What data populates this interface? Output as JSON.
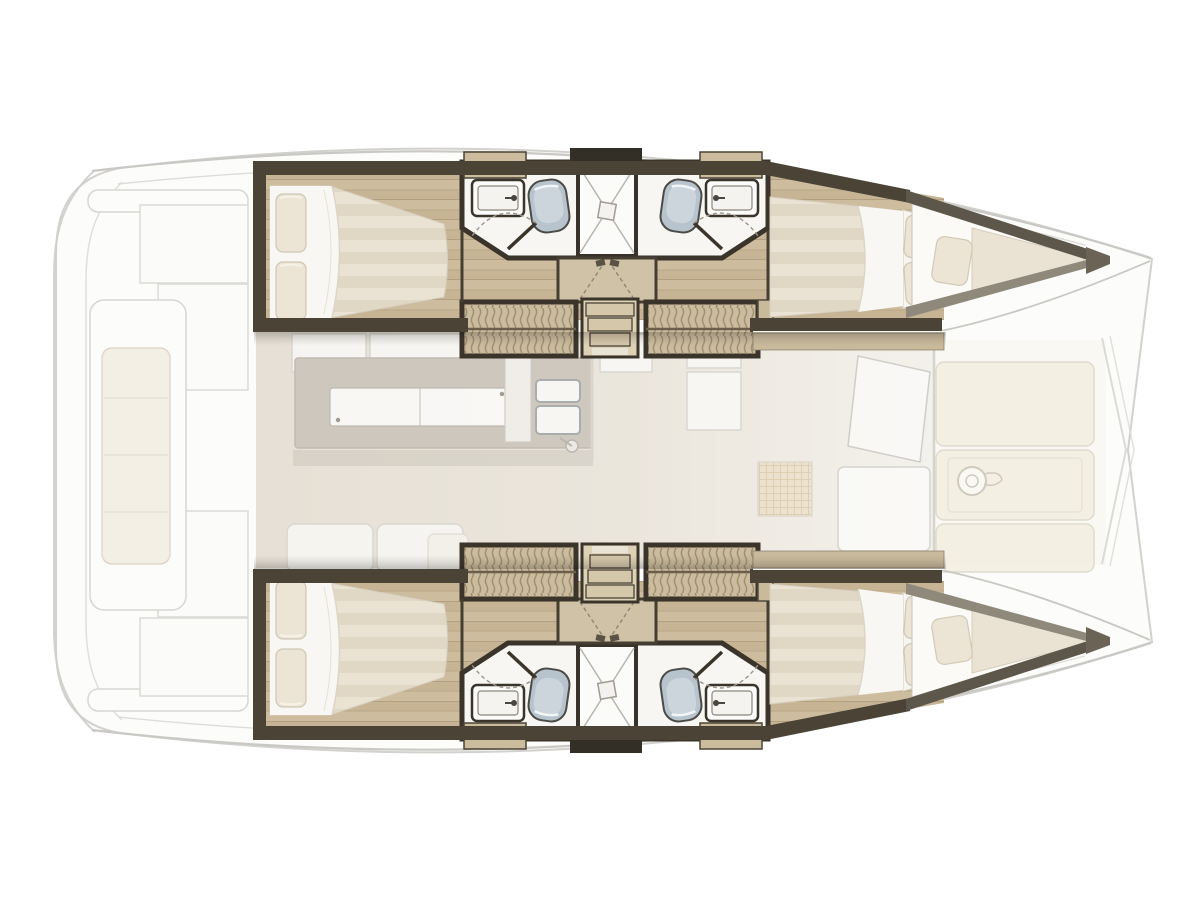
{
  "diagram": {
    "type": "floor-plan",
    "subject": "Catamaran yacht interior layout, top view, bow facing right",
    "style": "architectural rendering, no text labels",
    "symmetry": "port and starboard hulls mirrored about horizontal axis",
    "counts": {
      "double_cabins": 4,
      "bow_berths": 2,
      "toilets": 4,
      "washbasins": 4,
      "showers": 2,
      "companionway_stairs": 2
    },
    "zones": {
      "aft_deck": {
        "label": "aft cockpit and swim platforms",
        "items": [
          "swim-platform-curve",
          "transom-step-bar",
          "cockpit-locker",
          "cockpit-locker",
          "helm-bench",
          "bench-cushion"
        ]
      },
      "saloon": {
        "label": "bridge-deck saloon and galley",
        "items": [
          "overhead-cabinet",
          "overhead-cabinet",
          "galley-island",
          "island-countertop",
          "double-sink",
          "faucet",
          "sofa",
          "sofa",
          "chaise-pad",
          "chart-cabinet",
          "chart-table",
          "open-door-leaf",
          "wicker-stool",
          "saloon-table",
          "front-wall"
        ]
      },
      "port_hull": {
        "label": "port hull (top)",
        "rooms": [
          "aft-double-cabin",
          "en-suite-bathroom-aft",
          "central-shower",
          "en-suite-bathroom-fwd",
          "companionway",
          "forward-double-cabin",
          "bow-v-berth"
        ]
      },
      "starboard_hull": {
        "label": "starboard hull (bottom)",
        "rooms": [
          "aft-double-cabin",
          "en-suite-bathroom-aft",
          "central-shower",
          "en-suite-bathroom-fwd",
          "companionway",
          "forward-double-cabin",
          "bow-v-berth"
        ]
      },
      "foredeck": {
        "label": "foredeck lounge between bows",
        "items": [
          "sun-pad",
          "sun-pad",
          "sun-pad",
          "windlass-winch",
          "bridle-lines"
        ]
      }
    },
    "hull_room_contents": {
      "aft_cabin": [
        "double-berth",
        "duvet",
        "pillow",
        "pillow",
        "wood-floor"
      ],
      "bathrooms": [
        "washbasin",
        "toilet",
        "shower-with-x-pan",
        "toilet",
        "washbasin",
        "door-leaf",
        "door-swing-arc",
        "corner-shelf",
        "corner-shelf"
      ],
      "companionway": [
        "textured-tread-locker",
        "three-step-stair",
        "textured-tread-locker",
        "corridor-door-panel",
        "door-swing-dashes"
      ],
      "forward_cabin": [
        "double-berth",
        "duvet",
        "pillow",
        "pillow",
        "headboard",
        "side-shelf-band"
      ],
      "bow_berth": [
        "v-cushion",
        "square-pillow",
        "tip-block"
      ]
    }
  },
  "palette": {
    "background": "#ffffff",
    "faint_hull_fill": "#fcfcfa",
    "faint_line": "#cfcecA",
    "wall_dark": "#4a4336",
    "wall_border": "#3a342b",
    "wall_gray": "#8f897c",
    "wood_floor": "#c6b495",
    "wood_shelf": "#c9ba9c",
    "stair_fill": "#cbbc9f",
    "stair_texture": "#9a8966",
    "bed_cream": "#eae2d2",
    "bed_stripe": "#e0d7c4",
    "duvet_white": "#f8f7f3",
    "pillow": "#ece5d5",
    "bath_floor": "#f7f6f3",
    "toilet_blue": "#b7c3cd",
    "saloon_floor": "#e5ded3",
    "island_top": "#c8c1b7",
    "outdoor_cushion": "#f3eee1"
  }
}
